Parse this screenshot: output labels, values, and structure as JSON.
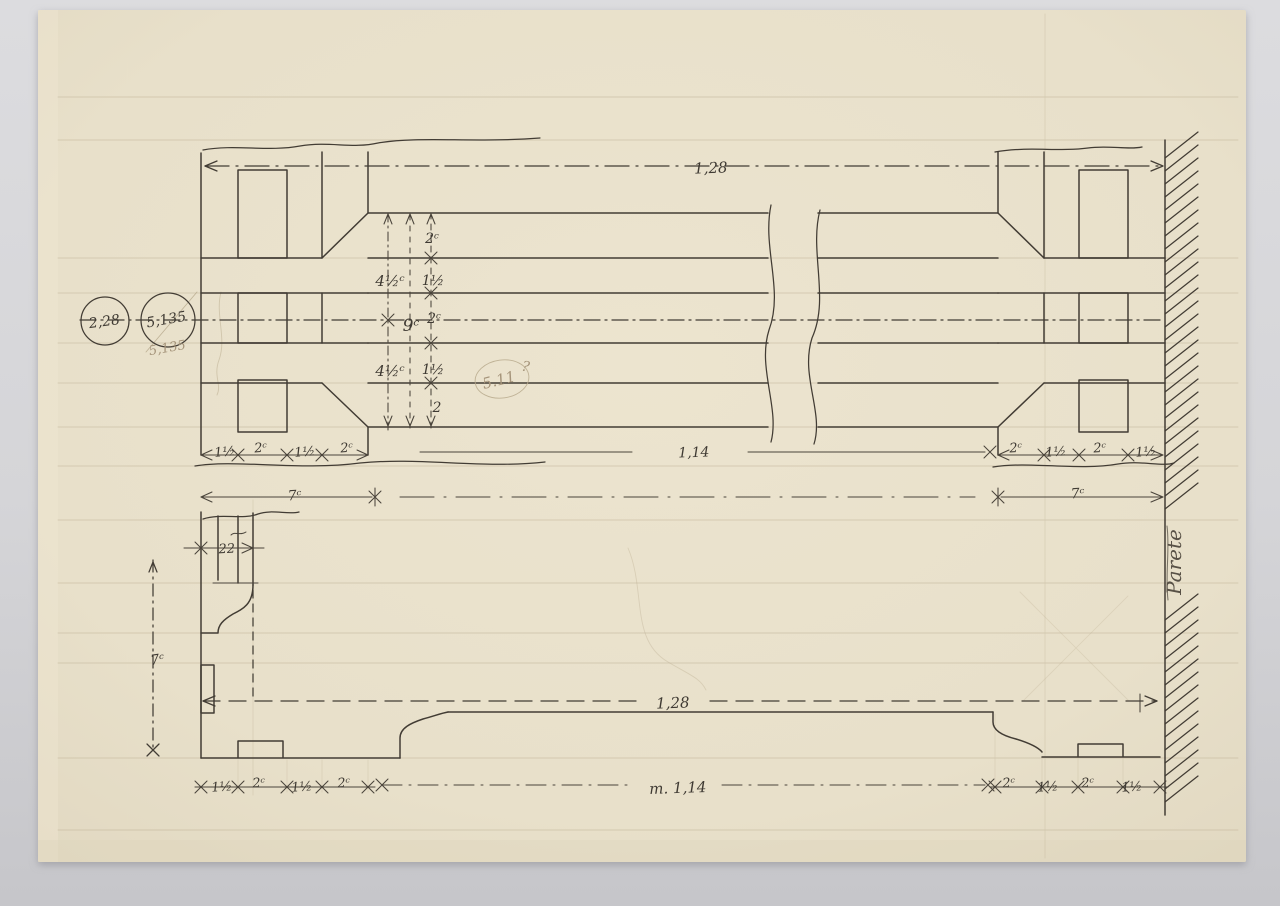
{
  "document": {
    "kind": "hand-drawn architectural detail drawing, ink and pencil on cream paper",
    "views": [
      "plan of frame against wall",
      "elevation / section of frame foot"
    ]
  },
  "colors": {
    "background": "#d5d5d8",
    "paper": "#e9e1cb",
    "ink": "#3f3a33",
    "pencil": "#a5947a"
  },
  "labels": {
    "dim_overall_top": "1,28",
    "dim_inner_top": "1,14",
    "dim_overall_bottom": "1,28",
    "dim_total_bottom": "m. 1,14",
    "circle_left": "2,28",
    "circle_right": "5,135",
    "pencil_below_circles": "5,135",
    "pencil_circled_note": "5.11",
    "pencil_question": "?",
    "stack": {
      "s1": "2ᶜ",
      "s2": "1½",
      "s3": "2ᶜ",
      "s4": "1½",
      "s5": "2",
      "left_upper": "4½ᶜ",
      "left_mid": "9ᶜ",
      "left_lower": "4½ᶜ"
    },
    "top_left_dims": [
      "1½",
      "2ᶜ",
      "1½",
      "2ᶜ"
    ],
    "top_right_dims": [
      "2ᶜ",
      "1½",
      "2ᶜ",
      "1½"
    ],
    "bottom_left_dims": [
      "1½",
      "2ᶜ",
      "1½",
      "2ᶜ"
    ],
    "bottom_right_dims": [
      "2ᶜ",
      "1½",
      "2ᶜ",
      "1½"
    ],
    "seven_left": "7ᶜ",
    "seven_right": "7ᶜ",
    "seven_vertical": "7ᶜ",
    "dim_22": "22",
    "wall_label": "Parete"
  }
}
